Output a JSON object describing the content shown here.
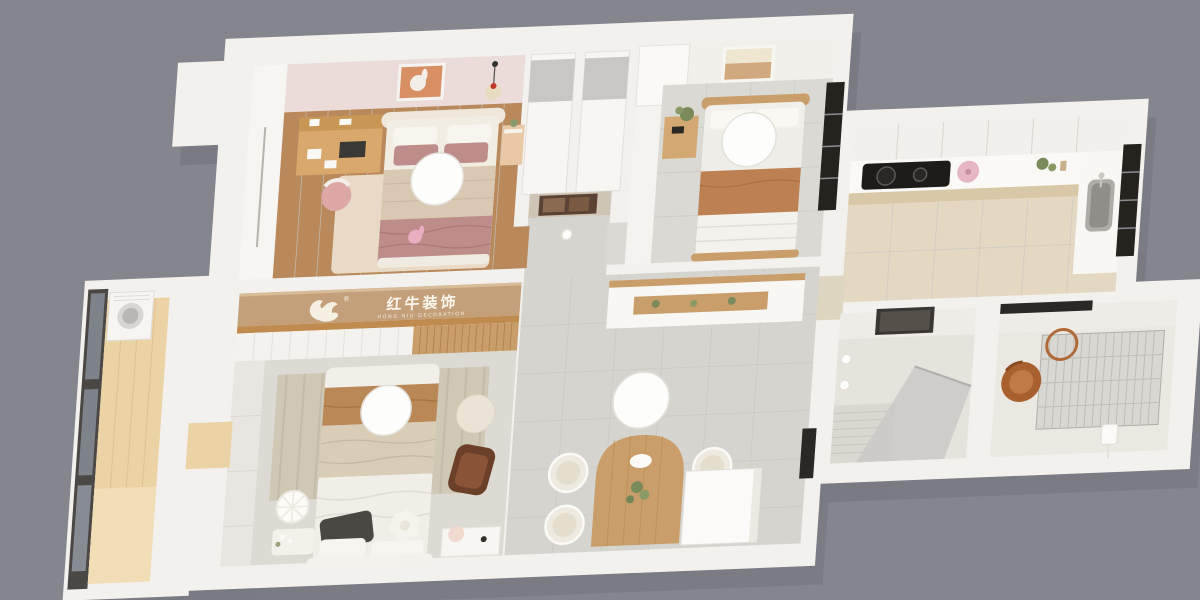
{
  "scene": {
    "description": "3D isometric dollhouse render of a small apartment floor plan",
    "background": "#85858D"
  },
  "logo": {
    "cn": "红牛装饰",
    "en": "HONG NIU DECORATION",
    "registered": "®"
  },
  "palette": {
    "bg": "#85858D",
    "shadow": "#70707A",
    "wall": "#F3F1EE",
    "wallFace": "#EFECE7",
    "pinkWall": "#EBDCDA",
    "woodFloor": "#B9895C",
    "wood": "#C99E6B",
    "tileGray": "#D6D4CF",
    "tileWarm": "#E4D8C2",
    "banner": "#C4A07A",
    "bannerSill": "#C08B4F",
    "caramel": "#BA8757",
    "mauve": "#BE8D8B",
    "beige": "#D9CDB8",
    "cream": "#EFEADF",
    "dark": "#26231F",
    "glass": "#7E838A",
    "balconyWood": "#EBD3A6",
    "copper": "#A9602F",
    "kettlePink": "#E6B6C4",
    "white": "#FDFDFC"
  }
}
